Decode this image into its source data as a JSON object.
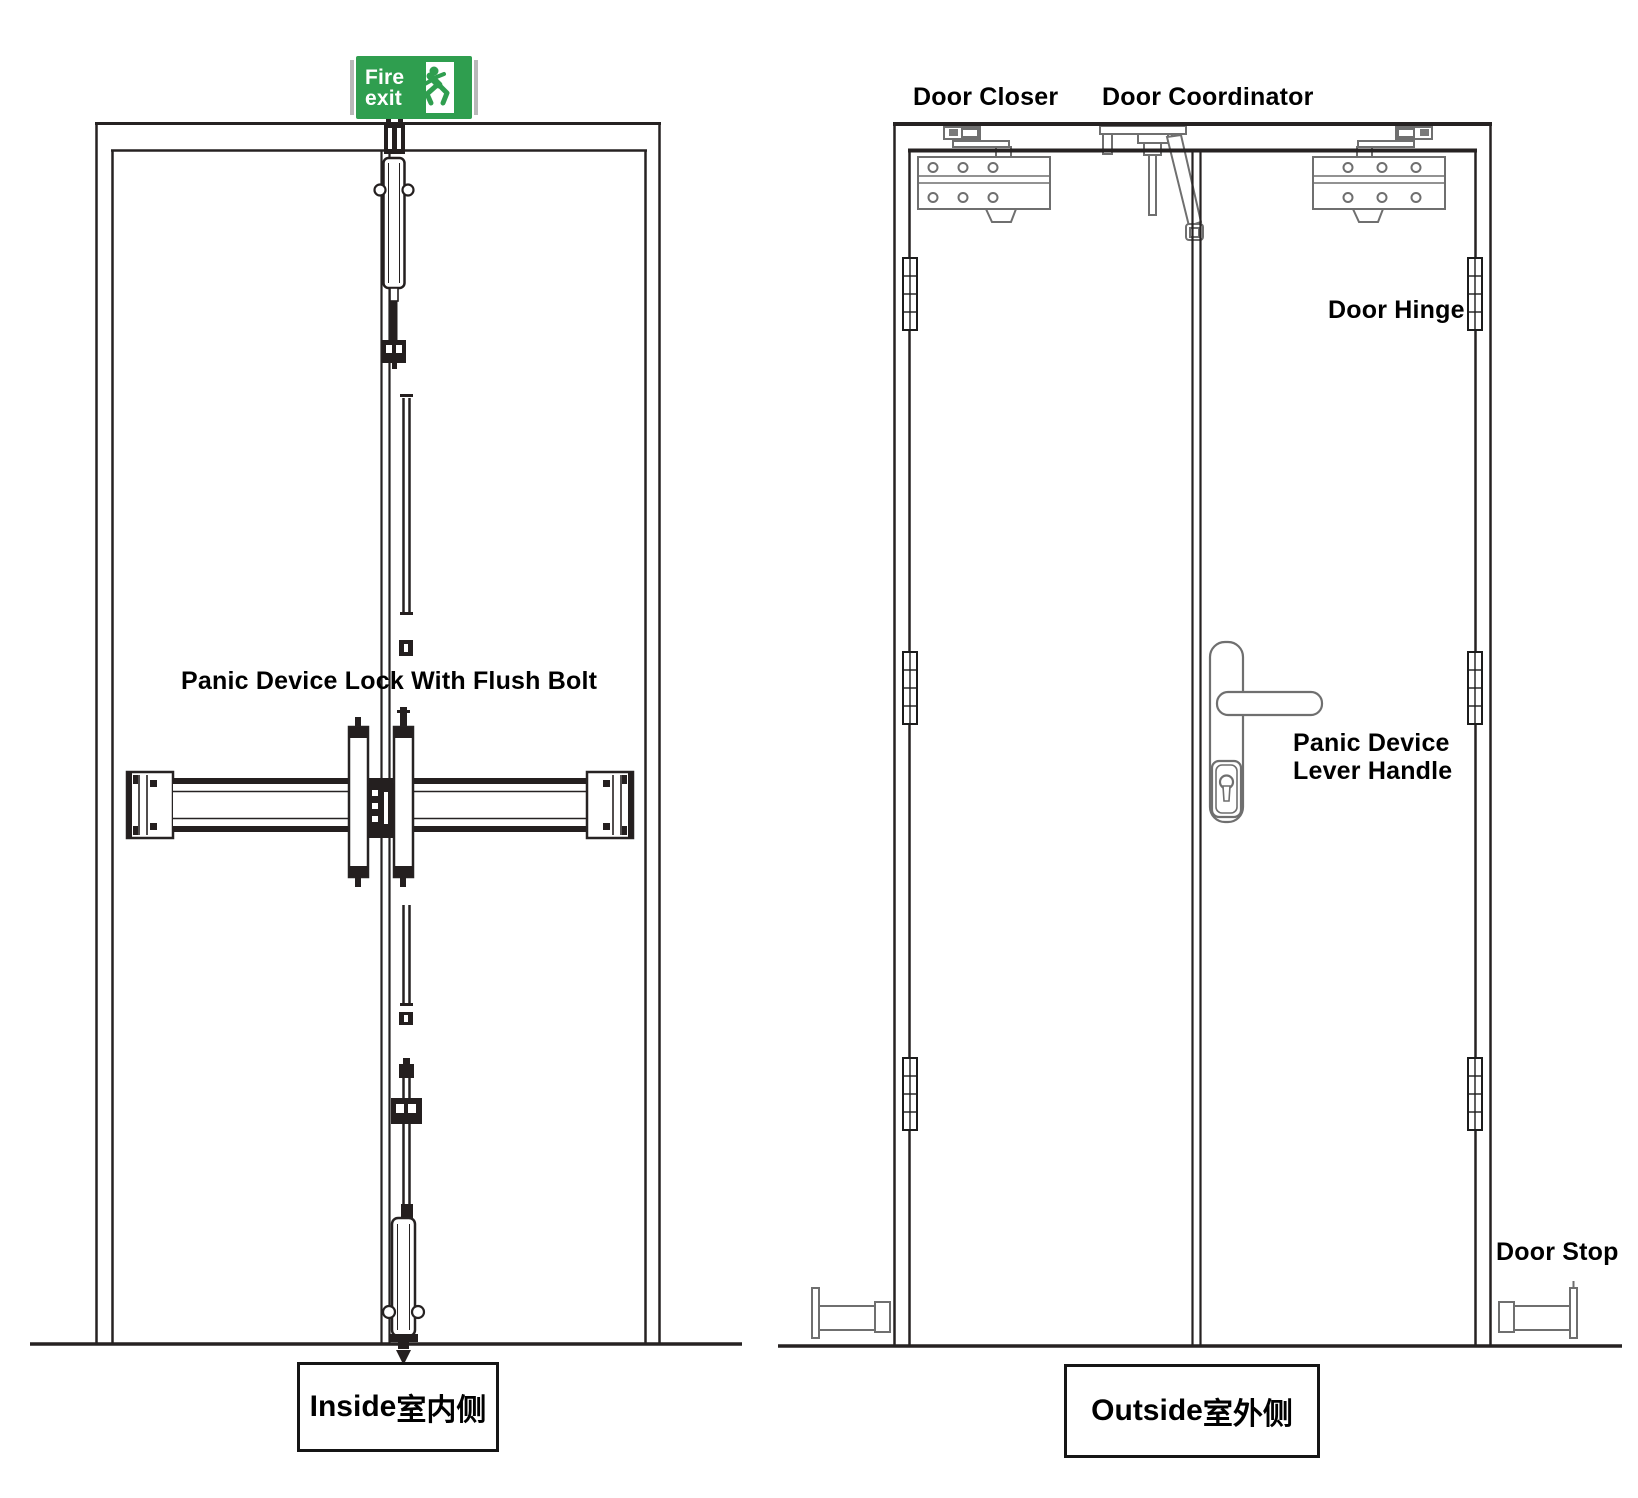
{
  "colors": {
    "background": "#ffffff",
    "line_dark": "#262222",
    "hardware_gray": "#6f6f6f",
    "sign_green": "#2f9e4f",
    "label_text": "#000000"
  },
  "fire_exit_sign": {
    "line1": "Fire",
    "line2": "exit",
    "icon": "running-man-exit-icon"
  },
  "inside_view": {
    "panic_lock_label": "Panic Device Lock With Flush Bolt",
    "caption": {
      "en": "Inside",
      "zh": "室内侧"
    }
  },
  "outside_view": {
    "door_closer_label": "Door Closer",
    "door_coordinator_label": "Door Coordinator",
    "door_hinge_label": "Door Hinge",
    "panic_lever_label_line1": "Panic Device",
    "panic_lever_label_line2": "Lever Handle",
    "door_stop_label": "Door Stop",
    "caption": {
      "en": "Outside",
      "zh": "室外侧"
    }
  }
}
